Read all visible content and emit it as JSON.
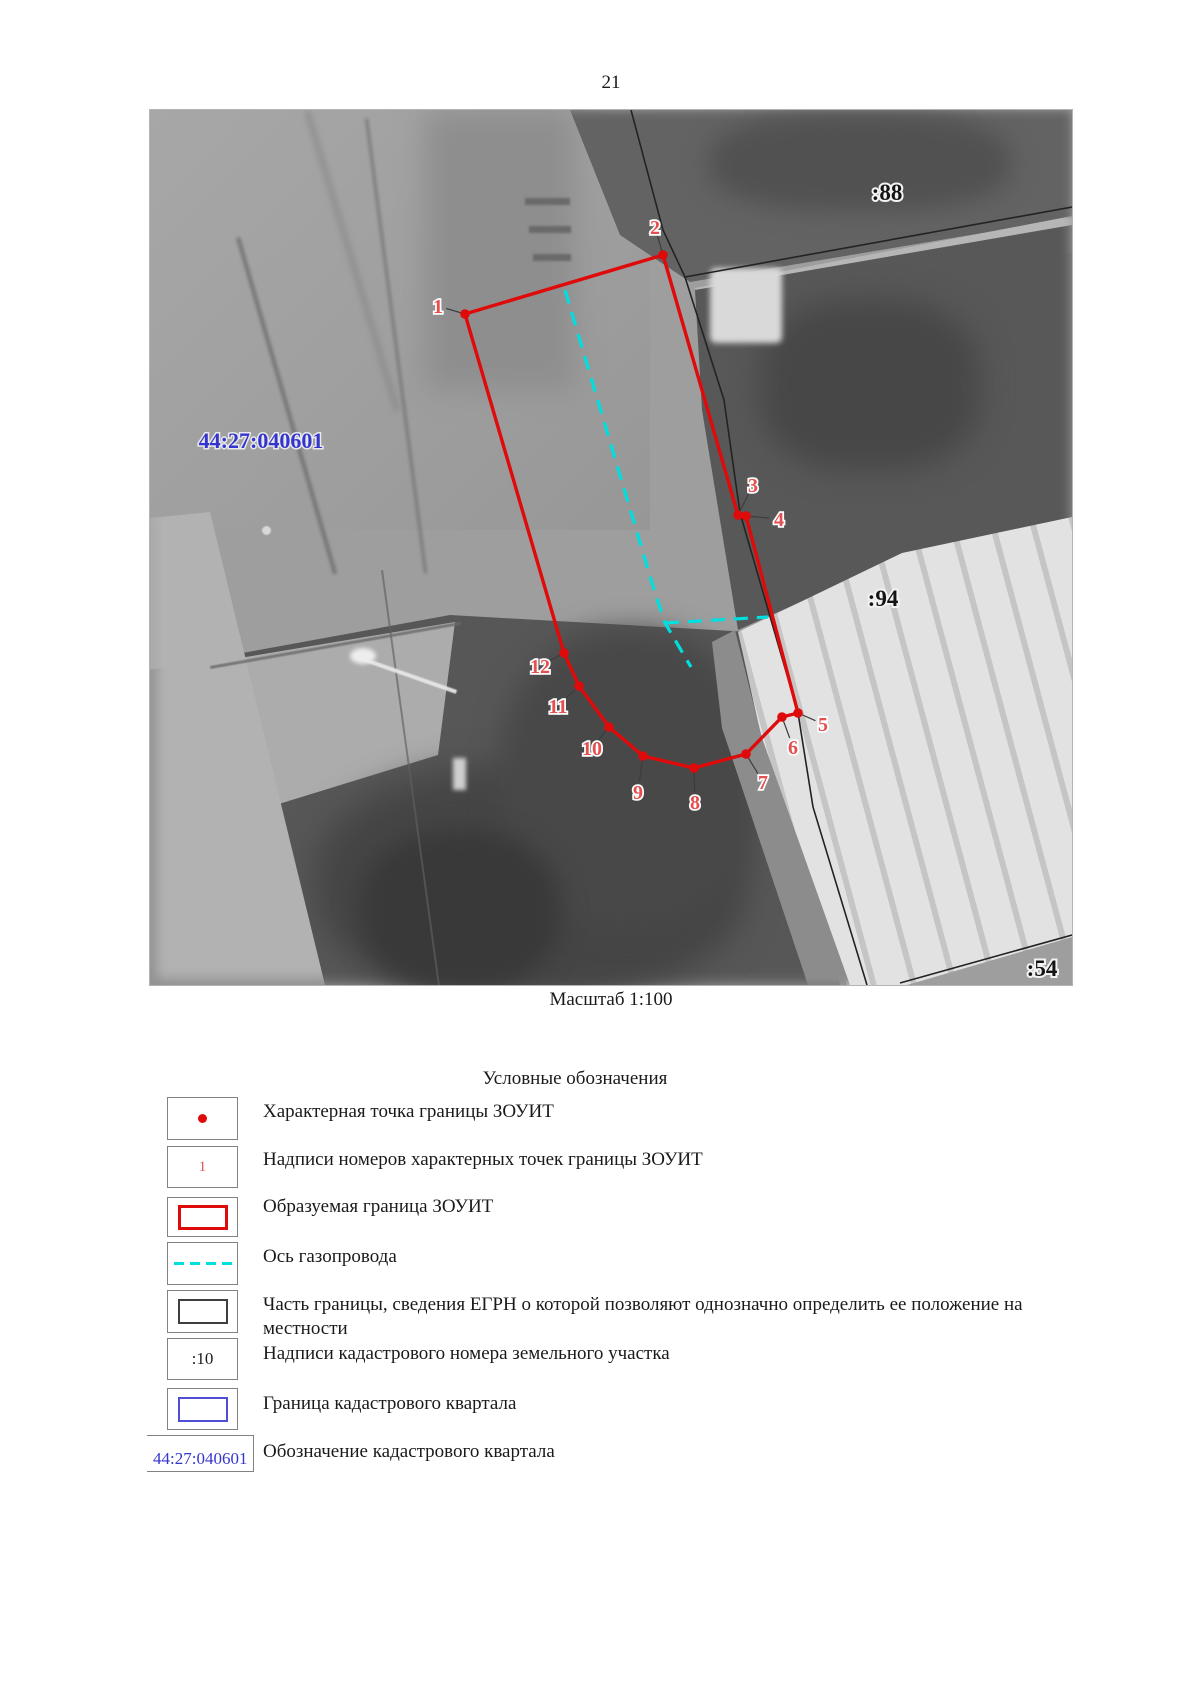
{
  "page_number": "21",
  "map": {
    "scale_label": "Масштаб 1:100",
    "cadastral_quarter": {
      "text": "44:27:040601",
      "x": 111,
      "y": 330
    },
    "parcel_labels": [
      {
        "text": ":88",
        "x": 737,
        "y": 82
      },
      {
        "text": ":94",
        "x": 733,
        "y": 488
      },
      {
        "text": ":54",
        "x": 892,
        "y": 858
      }
    ],
    "boundary_points": [
      {
        "n": "1",
        "px": 315,
        "py": 204,
        "lx": 288,
        "ly": 196
      },
      {
        "n": "2",
        "px": 513,
        "py": 145,
        "lx": 505,
        "ly": 117
      },
      {
        "n": "3",
        "px": 588,
        "py": 405,
        "lx": 603,
        "ly": 375
      },
      {
        "n": "4",
        "px": 596,
        "py": 406,
        "lx": 629,
        "ly": 409
      },
      {
        "n": "5",
        "px": 648,
        "py": 603,
        "lx": 673,
        "ly": 614
      },
      {
        "n": "6",
        "px": 632,
        "py": 607,
        "lx": 643,
        "ly": 637
      },
      {
        "n": "7",
        "px": 596,
        "py": 644,
        "lx": 613,
        "ly": 672
      },
      {
        "n": "8",
        "px": 544,
        "py": 658,
        "lx": 545,
        "ly": 692
      },
      {
        "n": "9",
        "px": 493,
        "py": 646,
        "lx": 488,
        "ly": 682
      },
      {
        "n": "10",
        "px": 459,
        "py": 617,
        "lx": 442,
        "ly": 638
      },
      {
        "n": "11",
        "px": 429,
        "py": 576,
        "lx": 408,
        "ly": 596
      },
      {
        "n": "12",
        "px": 414,
        "py": 543,
        "lx": 390,
        "ly": 556
      }
    ],
    "pipeline_axis": [
      [
        [
          415,
          180
        ],
        [
          505,
          483
        ],
        [
          515,
          513
        ],
        [
          541,
          557
        ]
      ],
      [
        [
          515,
          513
        ],
        [
          618,
          507
        ]
      ]
    ],
    "egrn_boundaries": [
      [
        [
          481,
          0
        ],
        [
          513,
          120
        ],
        [
          535,
          167
        ],
        [
          574,
          290
        ],
        [
          590,
          403
        ],
        [
          648,
          603
        ],
        [
          663,
          697
        ],
        [
          717,
          875
        ]
      ],
      [
        [
          535,
          167
        ],
        [
          922,
          97
        ]
      ],
      [
        [
          750,
          873
        ],
        [
          922,
          825
        ]
      ]
    ],
    "colors": {
      "zouit_boundary": "#df0a0a",
      "pipeline": "#00dfdf",
      "point_label": "#e44f4f",
      "egrn_line": "#232323",
      "quarter_text": "#3434cf"
    }
  },
  "legend": {
    "title": "Условные обозначения",
    "items": [
      {
        "label": "Характерная точка границы ЗОУИТ"
      },
      {
        "sample": "1",
        "label": "Надписи номеров характерных точек границы ЗОУИТ"
      },
      {
        "label": "Образуемая граница ЗОУИТ"
      },
      {
        "label": "Ось газопровода"
      },
      {
        "label": "Часть границы,  сведения  ЕГРН о которой позволяют однозначно определить ее положение на местности"
      },
      {
        "sample": ":10",
        "label": "Надписи кадастрового номера земельного участка"
      },
      {
        "label": "Граница кадастрового квартала"
      },
      {
        "sample": "44:27:040601",
        "label": "Обозначение кадастрового квартала"
      }
    ]
  }
}
